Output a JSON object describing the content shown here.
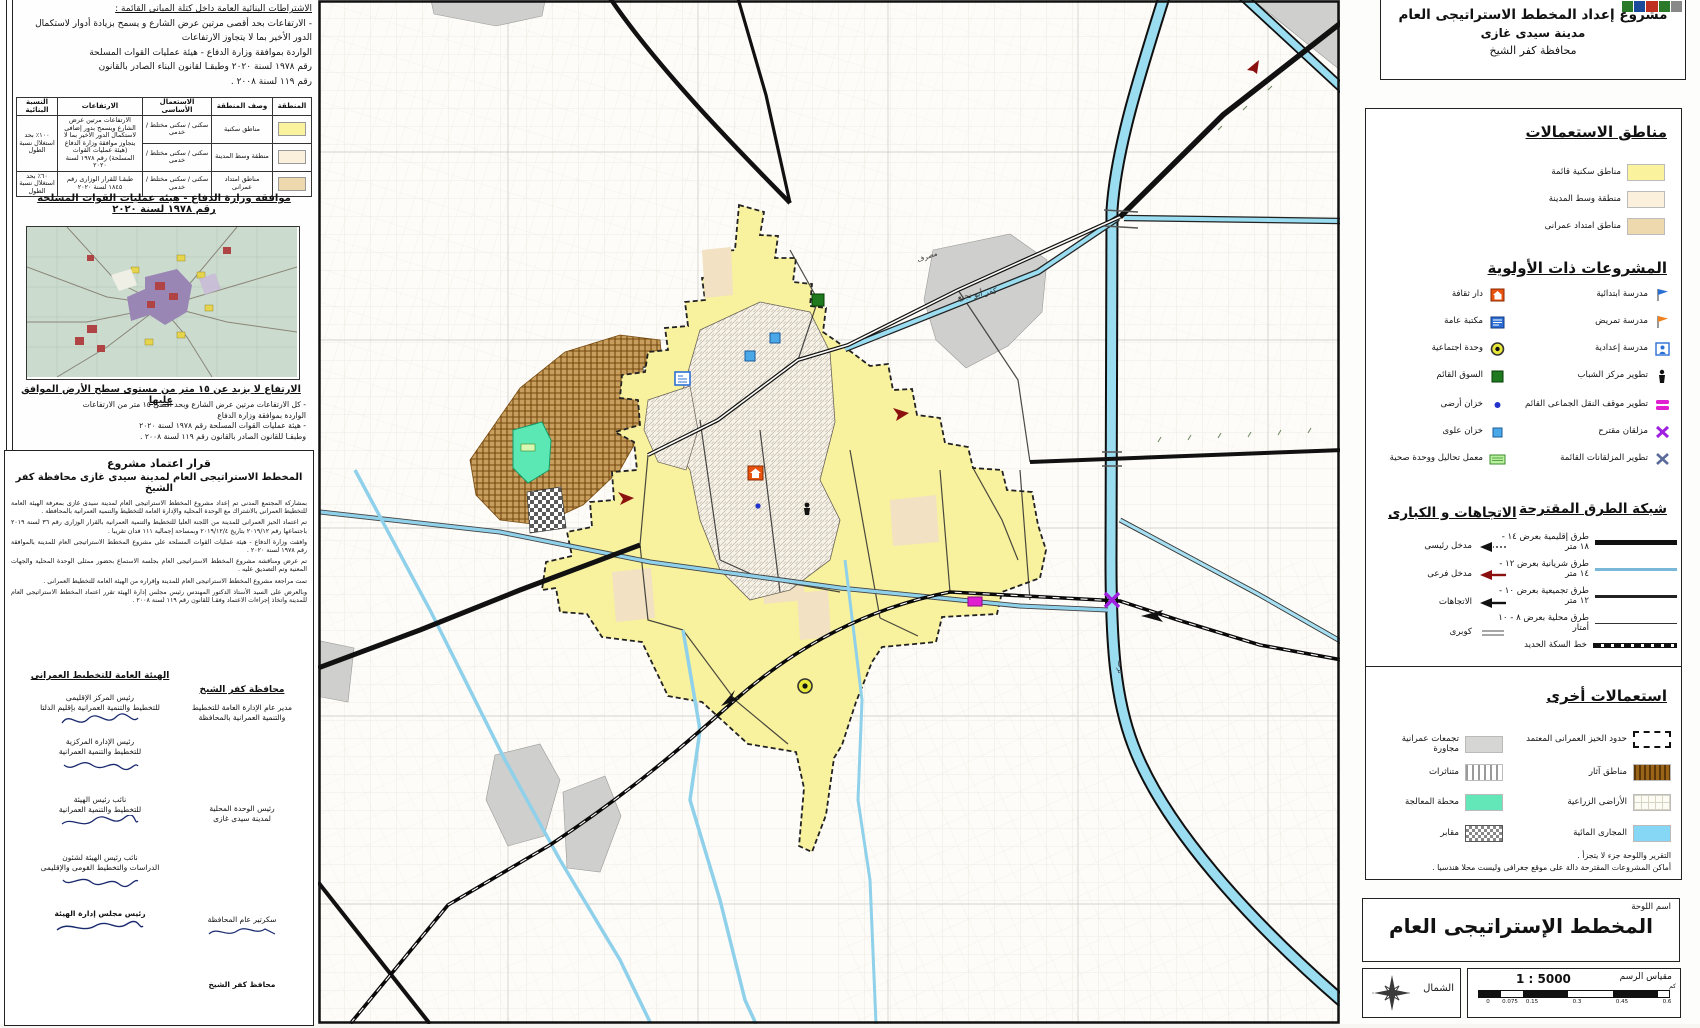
{
  "title_block": {
    "line1": "مشروع إعداد المخطط الاستراتيجى العام",
    "line2": "مدينة سيدى غازى",
    "line3": "محافظة كفر الشيخ"
  },
  "left_panel": {
    "top_note": [
      "الاشتراطات البنائية العامة داخل كتلة المبانى القائمة :",
      "- الارتفاعات بحد أقصى مرتين عرض الشارع و يسمح بزيادة أدوار لاستكمال",
      "الدور الأخير بما لا يتجاوز الارتفاعات",
      "الواردة بموافقة وزارة الدفاع - هيئة عمليات القوات المسلحة",
      "رقم ١٩٧٨ لسنة ٢٠٢٠ وطبقـا لقانون البناء الصادر بالقانون",
      "رقم ١١٩ لسنة ٢٠٠٨ ."
    ],
    "table": {
      "headers": [
        "المنطقة",
        "وصف المنطقة",
        "الاستعمال الأساسى",
        "الارتفاعات",
        "النسبة البنائية"
      ],
      "rows": [
        {
          "desc": "مناطق سكنية",
          "use": "سكنى / سكنى مختلط / خدمى"
        },
        {
          "desc": "منطقة وسط المدينة",
          "use": "سكنى / سكنى مختلط / خدمى"
        },
        {
          "desc": "مناطق امتداد عمرانى",
          "use": "سكنى / سكنى مختلط / خدمى"
        }
      ],
      "heights_main": "الارتفاعات مرتين عرض الشارع ويسمح بدور إضافى لاستكمال الدور الأخير بما لا يتجاوز موافقة وزارة الدفاع (هيئة عمليات القوات المسلحة) رقم ١٩٧٨ لسنة ٢٠٢٠",
      "heights_r3": "طبقـا للقرار الوزارى رقم ١٨٤٥ لسنة ٢٠٢٠",
      "ratio_main": "١٠٠٪ بحد استغلال نسبة الطول",
      "ratio_r3": "٦٠٪ بحد استغلال نسبة الطول"
    },
    "defense_h1": "موافقة وزارة الدفاع - هيئة عمليات القوات المسلحة",
    "defense_h2": "رقم ١٩٧٨ لسنة ٢٠٢٠",
    "height_h": "الارتفاع لا يزيد عن ١٥ متر من مستوى سطح الأرض الموافق عليها",
    "height_notes": [
      "- كل الارتفاعات مرتين عرض الشارع وبحد أقصى ١٥ متر من الارتفاعات",
      "الواردة بموافقة وزارة الدفاع",
      "- هيئة عمليات القوات المسلحة رقم ١٩٧٨ لسنة ٢٠٢٠",
      "وطبقـا للقانون الصادر بالقانون رقم ١١٩ لسنة ٢٠٠٨ ."
    ],
    "decree": {
      "h1": "قرار اعتماد مشروع",
      "h2": "المخطط الاستراتيجى العام لمدينة سيدى غازى محافظة كفر الشيخ",
      "paragraphs": [
        "بمشاركة المجتمع المدنى تم إعداد مشروع المخطط الاستراتيجى العام لمدينة سيدى غازى بمعرفة الهيئة العامة للتخطيط العمرانى بالاشتراك مع الوحدة المحلية والإدارة العامة للتخطيط والتنمية العمرانية بالمحافظة .",
        "تم اعتماد الحيز العمرانى للمدينة من اللجنة العليا للتخطيط والتنمية العمرانية بالقرار الوزارى رقم ٣٦ لسنة ٢٠١٩ باجتماعها رقم ٢٠١٩/١٢ بتاريخ ٢٠١٩/١٢/٤ وبمساحة إجمالية ١١١ فدان تقريبا .",
        "وافقت وزارة الدفاع - هيئة عمليات القوات المسلحة على مشروع المخطط الاستراتيجى العام للمدينة بالموافقة رقم ١٩٧٨ لسنة ٢٠٢٠ .",
        "تم عرض ومناقشة مشروع المخطط الاستراتيجى العام بجلسة الاستماع بحضور ممثلى الوحدة المحلية والجهات المعنية وتم التصديق عليه .",
        "تمت مراجعة مشروع المخطط الاستراتيجى العام للمدينة وإقراره من الهيئة العامة للتخطيط العمرانى .",
        "وبالعرض على السيد الأستاذ الدكتور المهندس رئيس مجلس إدارة الهيئة تقرر اعتماد المخطط الاستراتيجى العام للمدينة واتخاذ إجراءات الاعتماد وفقـا للقانون رقم ١١٩ لسنة ٢٠٠٨ ."
      ],
      "sig_left_header": "الهيئة العامة للتخطيط العمرانى",
      "sig_right_header": "محافظة كفر الشيخ",
      "sig_left": [
        {
          "t1": "رئيس المركز الإقليمى",
          "t2": "للتخطيط والتنمية العمرانية بإقليم الدلتا"
        },
        {
          "t1": "رئيس الإدارة المركزية",
          "t2": "للتخطيط والتنمية العمرانية"
        },
        {
          "t1": "نائب رئيس الهيئة",
          "t2": "للتخطيط والتنمية العمرانية"
        },
        {
          "t1": "نائب رئيس الهيئة لشئون",
          "t2": "الدراسات والتخطيط القومى والإقليمى"
        },
        {
          "t1": "رئيس مجلس إدارة الهيئة",
          "t2": ""
        }
      ],
      "sig_right": [
        {
          "t1": "مدير عام الإدارة العامة للتخطيط",
          "t2": "والتنمية العمرانية بالمحافظة"
        },
        {
          "t1": "رئيس الوحدة المحلية",
          "t2": "لمدينة سيدى غازى"
        },
        {
          "t1": "سكرتير عام المحافظة",
          "t2": ""
        },
        {
          "t1": "محافظ كفر الشيخ",
          "t2": ""
        }
      ]
    }
  },
  "legend": {
    "uses_title": "مناطق الاستعمالات",
    "uses": [
      {
        "label": "مناطق سكنية قائمة",
        "color": "#faf29c"
      },
      {
        "label": "منطقة وسط المدينة",
        "color": "#faf0dc"
      },
      {
        "label": "مناطق امتداد عمرانى",
        "color": "#eed9ae"
      }
    ],
    "priority_title": "المشروعات ذات الأولوية",
    "priority_right": [
      {
        "label": "مدرسة ابتدائية"
      },
      {
        "label": "مدرسة تمريض"
      },
      {
        "label": "مدرسة إعدادية"
      },
      {
        "label": "تطوير مركز الشباب"
      },
      {
        "label": "تطوير موقف النقل الجماعى القائم"
      },
      {
        "label": "مزلقان مقترح"
      },
      {
        "label": "تطوير المزلقانات القائمة"
      }
    ],
    "priority_left": [
      {
        "label": "دار ثقافة"
      },
      {
        "label": "مكتبة عامة"
      },
      {
        "label": "وحدة اجتماعية"
      },
      {
        "label": "السوق القائم"
      },
      {
        "label": "خزان أرضى"
      },
      {
        "label": "خزان علوى"
      },
      {
        "label": "معمل تحاليل ووحدة صحية"
      }
    ],
    "roads_title": "شبكة الطرق المقترحة",
    "roads": [
      {
        "label": "طرق إقليمية بعرض ١٤ - ١٨ متر"
      },
      {
        "label": "طرق شريانية بعرض ١٢ - ١٤ متر"
      },
      {
        "label": "طرق تجميعية بعرض ١٠ - ١٢ متر"
      },
      {
        "label": "طرق محلية بعرض ٨ - ١٠ أمتار"
      },
      {
        "label": "خط السكة الحديد"
      }
    ],
    "dirs_title": "الاتجاهات و الكبارى",
    "dirs": [
      {
        "label": "مدخل رئيسى"
      },
      {
        "label": "مدخل فرعى"
      },
      {
        "label": "الاتجاهات"
      },
      {
        "label": "كوبرى"
      }
    ],
    "other_title": "استعمالات أخرى",
    "other_right": [
      {
        "label": "حدود الحيز العمرانى المعتمد"
      },
      {
        "label": "مناطق آثار"
      },
      {
        "label": "الأراضى الزراعية"
      },
      {
        "label": "المجارى المائية"
      }
    ],
    "other_left": [
      {
        "label": "تجمعات عمرانية مجاورة"
      },
      {
        "label": "متناثرات"
      },
      {
        "label": "محطة المعالجة"
      },
      {
        "label": "مقابر"
      }
    ],
    "notes": [
      "التقرير واللوحة جزء لا يتجزأ .",
      "أماكن المشروعات المقترحة دالة على موقع جغرافى وليست محلا هندسيا ."
    ]
  },
  "sheet": {
    "label": "اسم اللوحة",
    "name": "المخطط الإستراتيجى العام"
  },
  "scale": {
    "label": "مقياس الرسم",
    "value": "1 : 5000",
    "unit": "كم",
    "ticks": [
      "0",
      "0.075",
      "0.15",
      "0.3",
      "0.45",
      "0.6"
    ]
  },
  "north_label": "الشمال",
  "map": {
    "labels": [
      {
        "text": "كفر أبو نجيع"
      },
      {
        "text": "ترعة"
      },
      {
        "text": "مصرف"
      }
    ]
  },
  "colors": {
    "urban": "#f8f19e",
    "city_center": "#f7ead0",
    "extension": "#eed9ae",
    "water": "#8fd0ea",
    "treatment": "#5ce8b4",
    "archaeology": "#caa264",
    "neighbor": "#cfcfcf",
    "transport_stop": "#e020d0",
    "crossing_proposed": "#a020e0",
    "market": "#1f7a1f",
    "culture": "#e8540e"
  }
}
